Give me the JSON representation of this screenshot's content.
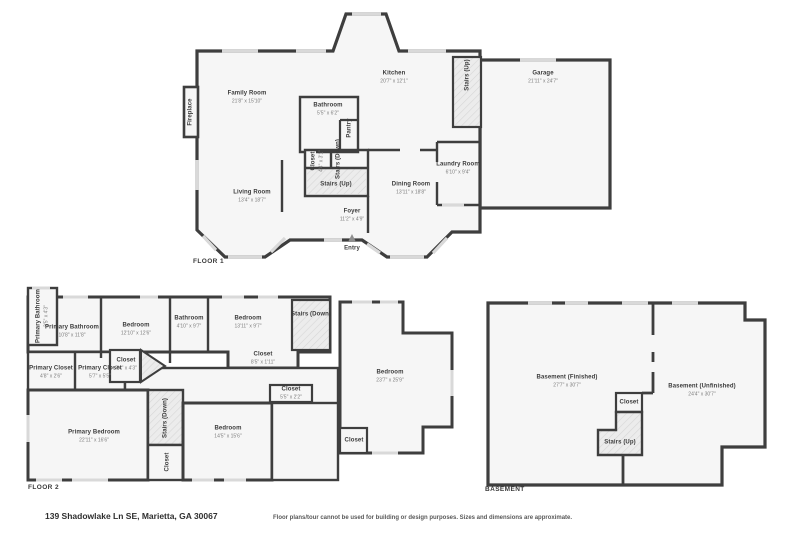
{
  "floors": [
    {
      "title": "FLOOR 1",
      "rooms": [
        {
          "id": "fireplace",
          "name": "Fireplace",
          "dims": ""
        },
        {
          "id": "family-room",
          "name": "Family Room",
          "dims": "21'8\" x 15'10\""
        },
        {
          "id": "bathroom",
          "name": "Bathroom",
          "dims": "5'5\" x 6'2\""
        },
        {
          "id": "pantry",
          "name": "Pantry",
          "dims": ""
        },
        {
          "id": "kitchen",
          "name": "Kitchen",
          "dims": "20'7\" x 12'1\""
        },
        {
          "id": "stairs-up-top",
          "name": "Stairs (Up)",
          "dims": ""
        },
        {
          "id": "garage",
          "name": "Garage",
          "dims": "21'11\" x 24'7\""
        },
        {
          "id": "laundry-room",
          "name": "Laundry Room",
          "dims": "6'10\" x 9'4\""
        },
        {
          "id": "closet",
          "name": "Closet",
          "dims": "4'4\" x 3'1\""
        },
        {
          "id": "stairs-down",
          "name": "Stairs (Down)",
          "dims": ""
        },
        {
          "id": "stairs-up-mid",
          "name": "Stairs (Up)",
          "dims": ""
        },
        {
          "id": "dining-room",
          "name": "Dining Room",
          "dims": "13'11\" x 18'8\""
        },
        {
          "id": "living-room",
          "name": "Living Room",
          "dims": "13'4\" x 18'7\""
        },
        {
          "id": "foyer",
          "name": "Foyer",
          "dims": "11'2\" x 4'9\""
        },
        {
          "id": "entry",
          "name": "Entry",
          "dims": ""
        }
      ]
    },
    {
      "title": "FLOOR 2",
      "rooms": [
        {
          "id": "primary-bathroom-small",
          "name": "Primary Bathroom",
          "dims": "3'5\" x 4'3\""
        },
        {
          "id": "primary-bathroom",
          "name": "Primary Bathroom",
          "dims": "10'8\" x 11'8\""
        },
        {
          "id": "bedroom-1",
          "name": "Bedroom",
          "dims": "12'10\" x 12'6\""
        },
        {
          "id": "bathroom-2",
          "name": "Bathroom",
          "dims": "4'10\" x 9'7\""
        },
        {
          "id": "bedroom-2",
          "name": "Bedroom",
          "dims": "13'11\" x 9'7\""
        },
        {
          "id": "stairs-down-top",
          "name": "Stairs (Down)",
          "dims": ""
        },
        {
          "id": "closet-wide",
          "name": "Closet",
          "dims": "8'5\" x 1'11\""
        },
        {
          "id": "closet-door",
          "name": "Closet",
          "dims": "7'4\" x 4'3\""
        },
        {
          "id": "primary-closet-1",
          "name": "Primary Closet",
          "dims": "4'8\" x 2'6\""
        },
        {
          "id": "primary-closet-2",
          "name": "Primary Closet",
          "dims": "5'7\" x 5'5\""
        },
        {
          "id": "bedroom-large",
          "name": "Bedroom",
          "dims": "23'7\" x 25'9\""
        },
        {
          "id": "closet-small",
          "name": "Closet",
          "dims": "5'5\" x 2'2\""
        },
        {
          "id": "primary-bedroom",
          "name": "Primary Bedroom",
          "dims": "22'11\" x 16'6\""
        },
        {
          "id": "stairs-down-2",
          "name": "Stairs (Down)",
          "dims": ""
        },
        {
          "id": "bedroom-3",
          "name": "Bedroom",
          "dims": "14'5\" x 15'6\""
        },
        {
          "id": "closet-vert",
          "name": "Closet",
          "dims": ""
        },
        {
          "id": "closet-br",
          "name": "Closet",
          "dims": ""
        }
      ]
    },
    {
      "title": "BASEMENT",
      "rooms": [
        {
          "id": "basement-finished",
          "name": "Basement (Finished)",
          "dims": "27'7\" x 30'7\""
        },
        {
          "id": "basement-unfinished",
          "name": "Basement (Unfinished)",
          "dims": "24'4\" x 30'7\""
        },
        {
          "id": "closet-b",
          "name": "Closet",
          "dims": ""
        },
        {
          "id": "stairs-up-b",
          "name": "Stairs (Up)",
          "dims": ""
        }
      ]
    }
  ],
  "footer": {
    "address": "139 Shadowlake Ln SE, Marietta, GA 30067",
    "disclaimer": "Floor plans/tour cannot be used for building or design purposes. Sizes and dimensions are approximate."
  },
  "colors": {
    "wall": "#3e3e3e",
    "floor_fill": "#f6f6f6",
    "stairs_fill": "#ececec",
    "window": "#d9d9d9"
  }
}
